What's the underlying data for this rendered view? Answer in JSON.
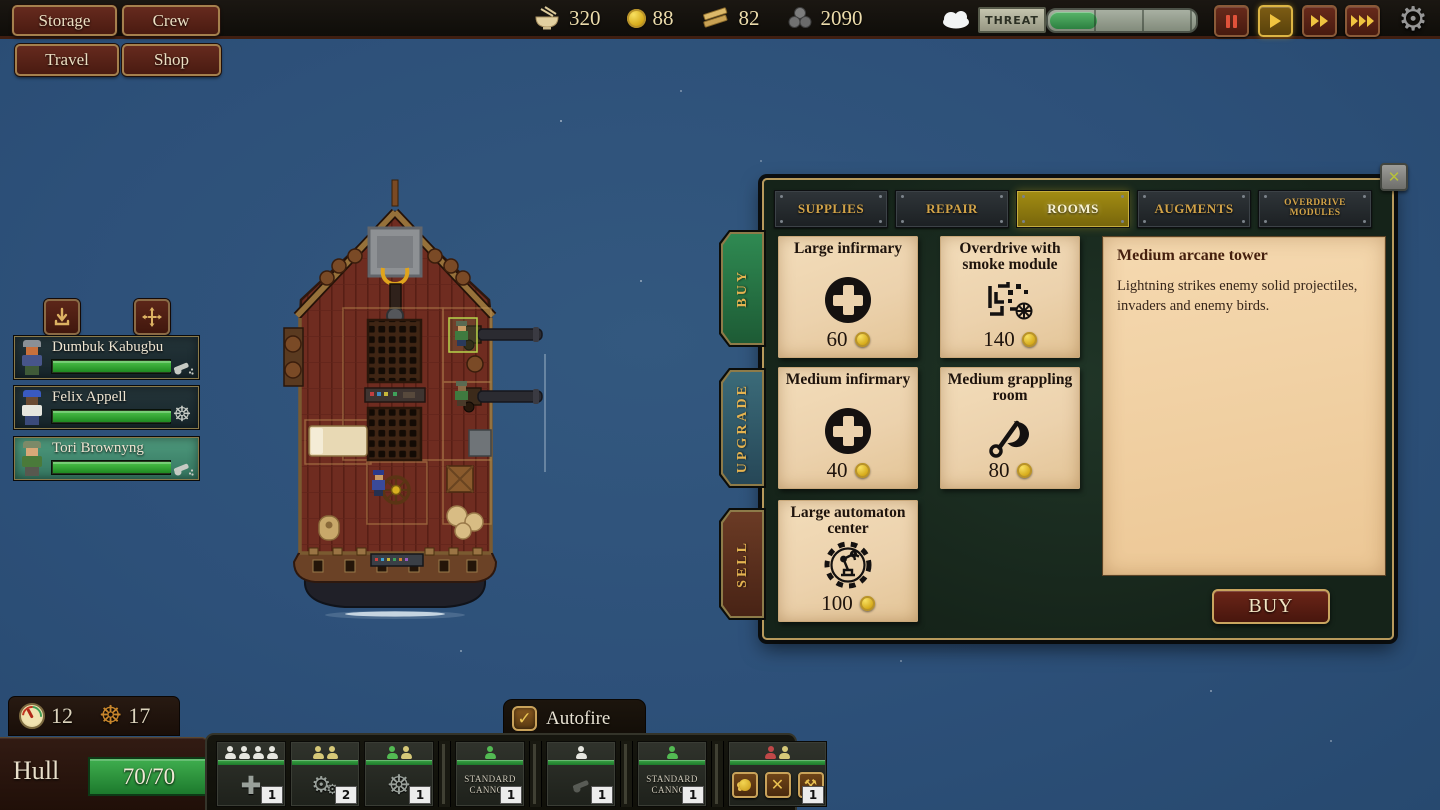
{
  "header": {
    "menu_buttons": [
      {
        "label": "Storage"
      },
      {
        "label": "Crew"
      }
    ],
    "nav_buttons": [
      {
        "label": "Travel"
      },
      {
        "label": "Shop"
      }
    ],
    "resources": [
      {
        "icon": "food-bowl-icon",
        "value": "320"
      },
      {
        "icon": "gold-coin-icon",
        "value": "88"
      },
      {
        "icon": "planks-icon",
        "value": "82"
      },
      {
        "icon": "cannonballs-icon",
        "value": "2090"
      }
    ],
    "weather_icon": "cloud-icon",
    "threat": {
      "label": "THREAT",
      "fill_percent": 32
    },
    "speed_controls": [
      {
        "name": "pause"
      },
      {
        "name": "play",
        "active": true
      },
      {
        "name": "fast-forward"
      },
      {
        "name": "fastest"
      }
    ],
    "settings_icon": "gear-icon",
    "gear_glyph": "⚙"
  },
  "crew_panel": {
    "actions": [
      {
        "icon": "send-below-icon"
      },
      {
        "icon": "move-crew-icon"
      }
    ],
    "members": [
      {
        "name": "Dumbuk Kabugbu",
        "health_percent": 100,
        "role": "cannon",
        "avatar": {
          "hat": "#8a9096",
          "skin": "#c8703c",
          "shirt": "#47558a",
          "pants": "#3f5a38"
        }
      },
      {
        "name": "Felix Appell",
        "health_percent": 100,
        "role": "helm",
        "avatar": {
          "hat": "#3a5ac0",
          "skin": "#6a4a32",
          "shirt": "#e6e6de",
          "pants": "#3a4a7a"
        }
      },
      {
        "name": "Tori Brownyng",
        "health_percent": 100,
        "role": "cannon",
        "selected": true,
        "avatar": {
          "hat": "#7c8a68",
          "skin": "#d8a878",
          "shirt": "#4a7a3a",
          "pants": "#58584f"
        }
      }
    ]
  },
  "shop": {
    "tabs": [
      {
        "label": "Supplies"
      },
      {
        "label": "Repair"
      },
      {
        "label": "Rooms",
        "active": true
      },
      {
        "label": "Augments"
      },
      {
        "label": "Overdrive Modules"
      }
    ],
    "side_tabs": [
      {
        "label": "Buy",
        "active": true
      },
      {
        "label": "Upgrade"
      },
      {
        "label": "Sell"
      }
    ],
    "items": [
      {
        "name": "Large infirmary",
        "icon": "infirmary-cross-icon",
        "price": "60"
      },
      {
        "name": "Overdrive with smoke module",
        "icon": "overdrive-circuit-icon",
        "price": "140"
      },
      {
        "name": "Medium infirmary",
        "icon": "infirmary-cross-icon",
        "price": "40"
      },
      {
        "name": "Medium grappling room",
        "icon": "grappling-hook-icon",
        "price": "80"
      },
      {
        "name": "Large automaton center",
        "icon": "automaton-gear-icon",
        "price": "100"
      }
    ],
    "detail": {
      "title": "Medium arcane tower",
      "description": "Lightning strikes enemy solid projectiles, invaders and enemy birds."
    },
    "buy_button_label": "BUY"
  },
  "status": {
    "stats": [
      {
        "icon": "gauge-icon",
        "value": "12"
      },
      {
        "icon": "ship-wheel-icon",
        "value": "17"
      }
    ],
    "hull": {
      "label": "Hull",
      "value": "70/70",
      "percent": 100
    }
  },
  "autofire": {
    "label": "Autofire",
    "checked": true
  },
  "rooms_bar": {
    "slots": [
      {
        "room": "infirmary",
        "icon": "medical-cross-icon",
        "crew": [
          "white",
          "white",
          "white",
          "white"
        ],
        "badge": "1"
      },
      {
        "room": "engine",
        "icon": "gears-icon",
        "crew": [
          "yellow",
          "yellow"
        ],
        "badge": "2"
      },
      {
        "room": "helm",
        "icon": "ship-wheel-icon",
        "crew": [
          "green",
          "yellow"
        ],
        "badge": "1"
      },
      {
        "room": "cannon",
        "label": "STANDARD CANNON",
        "crew": [
          "green"
        ],
        "badge": "1"
      },
      {
        "room": "cannon-empty",
        "icon": "cannon-icon",
        "crew": [
          "white"
        ],
        "badge": "1"
      },
      {
        "room": "cannon",
        "label": "STANDARD CANNON",
        "crew": [
          "green"
        ],
        "badge": "1"
      },
      {
        "room": "deck",
        "crew": [
          "red",
          "yellow"
        ],
        "badge": "1",
        "actions": [
          {
            "icon": "ranged-attack-icon"
          },
          {
            "icon": "melee-attack-icon"
          },
          {
            "icon": "repair-tools-icon"
          }
        ]
      }
    ]
  },
  "glyphs": {
    "wheel": "☸",
    "cross": "✚",
    "gear_big": "⚙",
    "gear_small": "⚙",
    "tools": "⚒",
    "x": "✕"
  },
  "colors": {
    "accent_gold": "#d2a348",
    "parchment": "#ecd2ad",
    "threat_green": "#3f9e54",
    "sea": "#2f5480"
  }
}
